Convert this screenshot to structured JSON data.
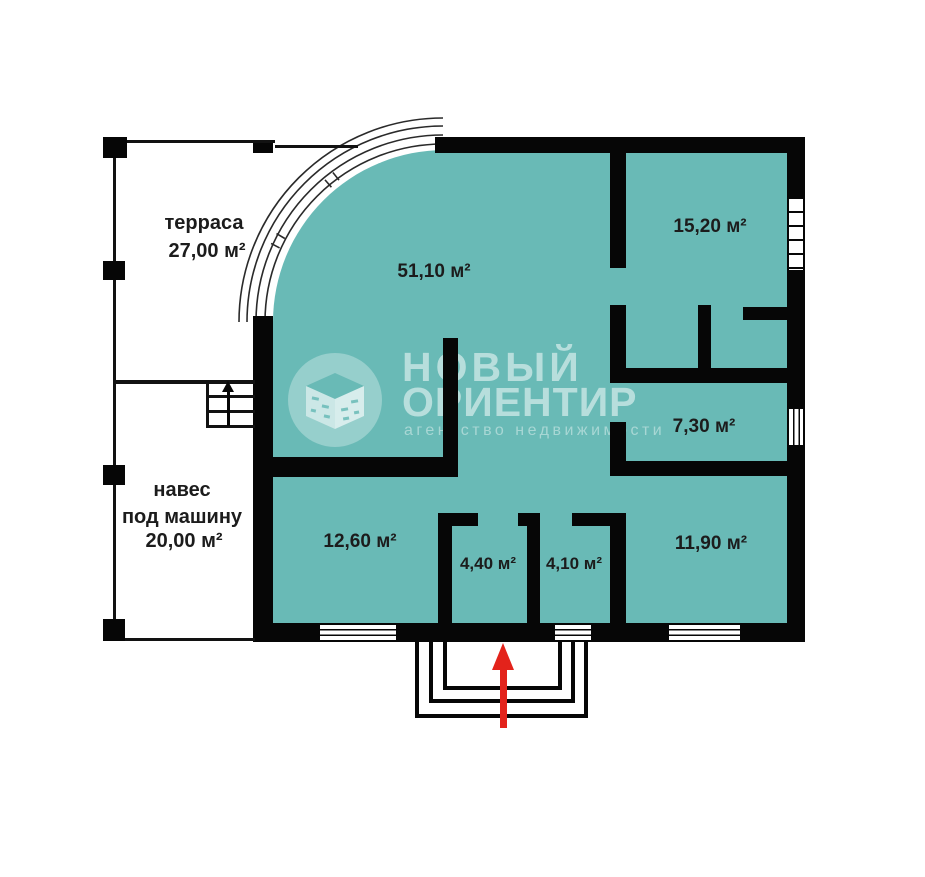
{
  "watermark": {
    "title_line1": "НОВЫЙ",
    "title_line2": "ОРИЕНТИР",
    "tagline": "агентство недвижимости"
  },
  "rooms": {
    "terrace": {
      "name": "терраса",
      "area": "27,00 м²"
    },
    "living": {
      "area": "51,10 м²"
    },
    "bedroom": {
      "area": "15,20 м²"
    },
    "hallway": {
      "area": "7,30 м²"
    },
    "carport": {
      "name_line1": "навес",
      "name_line2": "под машину",
      "area": "20,00 м²"
    },
    "room_12_60": {
      "area": "12,60 м²"
    },
    "room_4_40": {
      "area": "4,40 м²"
    },
    "room_4_10": {
      "area": "4,10 м²"
    },
    "room_11_90": {
      "area": "11,90 м²"
    }
  },
  "colors": {
    "floor_fill": "#69bab6",
    "wall": "#060606",
    "entrance_arrow": "#e3231b",
    "watermark_text": "rgba(255,255,255,0.52)"
  },
  "symbols": {
    "entrance_arrow": "red arrow pointing up into entrance door",
    "stairs_arrow": "black arrow pointing up the stairs",
    "logo_icon": "isometric open box in circle"
  }
}
